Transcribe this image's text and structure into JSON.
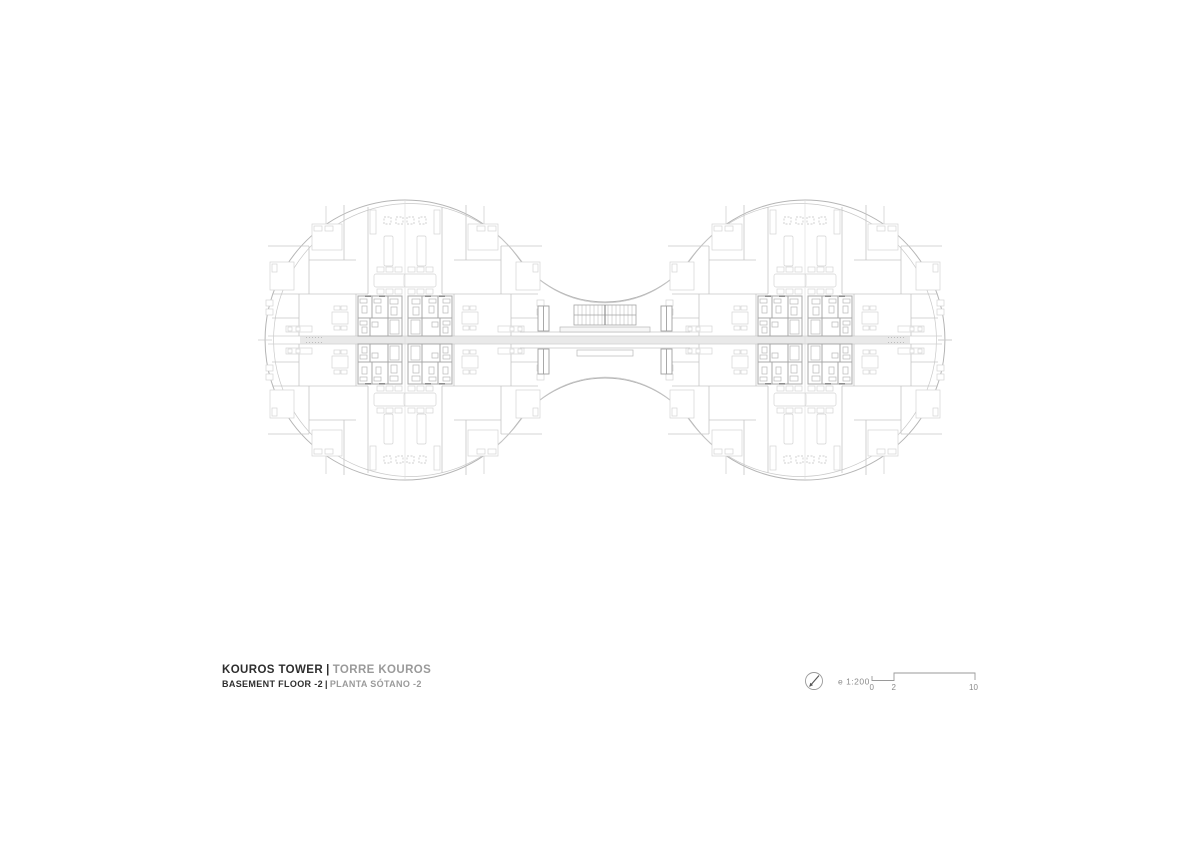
{
  "title_block": {
    "title_primary": "KOUROS TOWER",
    "separator": "|",
    "title_secondary": "TORRE KOUROS",
    "subtitle_primary": "BASEMENT FLOOR -2",
    "subtitle_secondary": "PLANTA SÓTANO -2"
  },
  "scale_bar": {
    "scale_label": "e 1:200",
    "tick_labels": [
      "0",
      "2",
      "10"
    ],
    "north_icon": "north-arrow-icon"
  },
  "plan": {
    "type": "architectural-floor-plan",
    "shape": "two circular lobes joined by a central stair corridor (dumbbell)",
    "colors": {
      "background": "#ffffff",
      "outline": "#b5b5b5",
      "wall_light": "#c6c6c6",
      "wall_medium": "#a8a8a8",
      "furniture": "#d4d4d4",
      "band_fill": "#e9e9e9",
      "title_dark": "#2e2e2e",
      "text_gray": "#9a9a9a"
    }
  }
}
